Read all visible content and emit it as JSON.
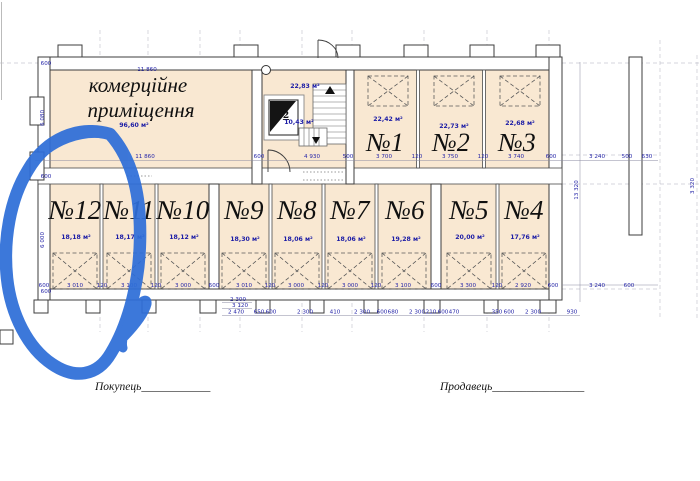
{
  "plan": {
    "commercial": {
      "label_line1": "комерційне",
      "label_line2": "приміщення",
      "area": "96,60 м²"
    },
    "stairwell": {
      "area": "22,83 м²",
      "stairs_area": "10,43 м²",
      "elevator": "2"
    },
    "rooms_top": [
      {
        "name": "№1",
        "area": "22,42 м²"
      },
      {
        "name": "№2",
        "area": "22,73 м²"
      },
      {
        "name": "№3",
        "area": "22,68 м²"
      }
    ],
    "rooms_bottom": [
      {
        "name": "№12",
        "area": "18,18 м²"
      },
      {
        "name": "№11",
        "area": "18,17 м²"
      },
      {
        "name": "№10",
        "area": "18,12 м²"
      },
      {
        "name": "№9",
        "area": "18,30 м²"
      },
      {
        "name": "№8",
        "area": "18,06 м²"
      },
      {
        "name": "№7",
        "area": "18,06 м²"
      },
      {
        "name": "№6",
        "area": "19,28 м²"
      },
      {
        "name": "№5",
        "area": "20,00 м²"
      },
      {
        "name": "№4",
        "area": "17,76 м²"
      }
    ]
  },
  "dims": {
    "top": "11 860",
    "mid": [
      "11 860",
      "600",
      "4 930",
      "500",
      "3 700",
      "120",
      "3 750",
      "120",
      "3 740",
      "600",
      "3 240",
      "500",
      "630"
    ],
    "bottom": [
      "600",
      "3 010",
      "120",
      "3 100",
      "120",
      "3 000",
      "600",
      "3 010",
      "120",
      "3 000",
      "120",
      "3 000",
      "120",
      "3 100",
      "600",
      "3 300",
      "120",
      "2 920",
      "600",
      "3 240",
      "600"
    ],
    "sub": [
      "2 300",
      "3 120",
      "2 470",
      "650",
      "600",
      "2 300",
      "410",
      "2 300",
      "600",
      "680",
      "2 300",
      "210",
      "600",
      "470",
      "350",
      "600",
      "2 300",
      "930"
    ],
    "left": [
      "600",
      "6 080",
      "600",
      "6 000",
      "600"
    ],
    "right_v": "13 320",
    "far_right_v": "3 320"
  },
  "signatures": {
    "buyer": "Покупець____________",
    "seller": "Продавець________________"
  },
  "annotation": {
    "marker_color": "#2e6ed8",
    "target": "№12"
  }
}
